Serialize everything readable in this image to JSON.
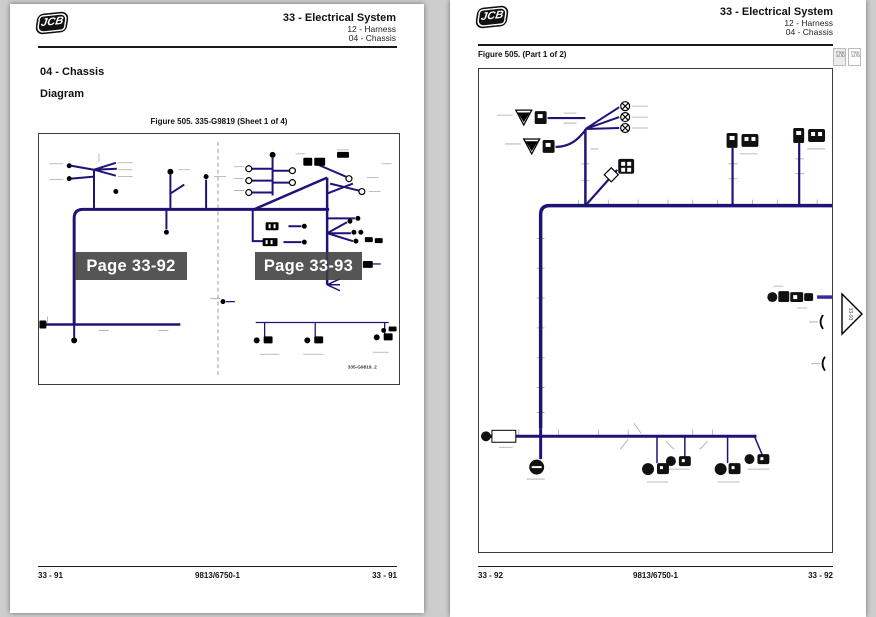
{
  "colors": {
    "wire_navy": "#1e1377",
    "wire_purple": "#3a2a9a",
    "overlay_gray": "#3e3e3e",
    "paper_white": "#ffffff",
    "canvas_gray": "#cdcdcd"
  },
  "left_page": {
    "logo_text": "JCB",
    "header": {
      "line1": "33 - Electrical System",
      "line2": "12 - Harness",
      "line3": "04 - Chassis"
    },
    "section_title": "04 - Chassis",
    "subsection_title": "Diagram",
    "figure_caption": "Figure 505. 335-G9819 (Sheet 1 of 4)",
    "drawing_ref": "335-G9819_2",
    "page_links": [
      {
        "label": "Page 33-92"
      },
      {
        "label": "Page 33-93"
      }
    ],
    "footer": {
      "page_left": "33 - 91",
      "doc_ref": "9813/6750-1",
      "page_right": "33 - 91"
    }
  },
  "right_page": {
    "logo_text": "JCB",
    "header": {
      "line1": "33 - Electrical System",
      "line2": "12 - Harness",
      "line3": "04 - Chassis"
    },
    "figure_caption": "Figure 505. (Part 1 of 2)",
    "page_links_small": [
      {
        "line1": "Page",
        "line2": "33-92"
      },
      {
        "line1": "Page",
        "line2": "33-93"
      }
    ],
    "continuation_label": "33-93",
    "footer": {
      "page_left": "33 - 92",
      "doc_ref": "9813/6750-1",
      "page_right": "33 - 92"
    }
  }
}
